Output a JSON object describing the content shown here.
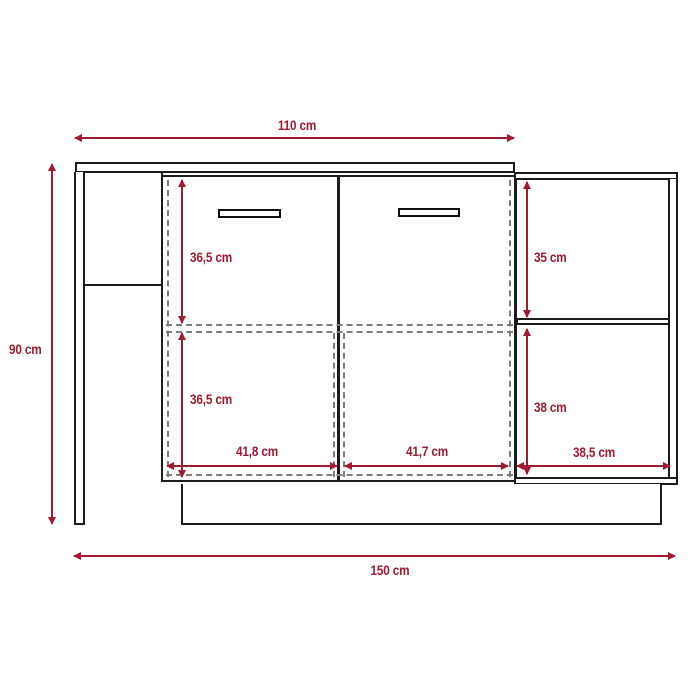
{
  "diagram": {
    "type": "furniture-dimension-drawing",
    "subject": "kitchen-island-cabinet-front-view",
    "colors": {
      "dimension_red": "#9e1b32",
      "outline_black": "#1c1c1c",
      "hidden_line_gray": "#7d7d7d",
      "background": "#ffffff"
    },
    "labels": {
      "counter_width": "110 cm",
      "total_height": "90 cm",
      "total_width": "150 cm",
      "left_upper_interior_height": "36,5 cm",
      "left_lower_interior_height": "36,5 cm",
      "right_upper_shelf_height": "35 cm",
      "right_lower_shelf_height": "38 cm",
      "left_door_interior_width": "41,8 cm",
      "right_door_interior_width": "41,7 cm",
      "side_shelf_interior_width": "38,5 cm"
    }
  }
}
